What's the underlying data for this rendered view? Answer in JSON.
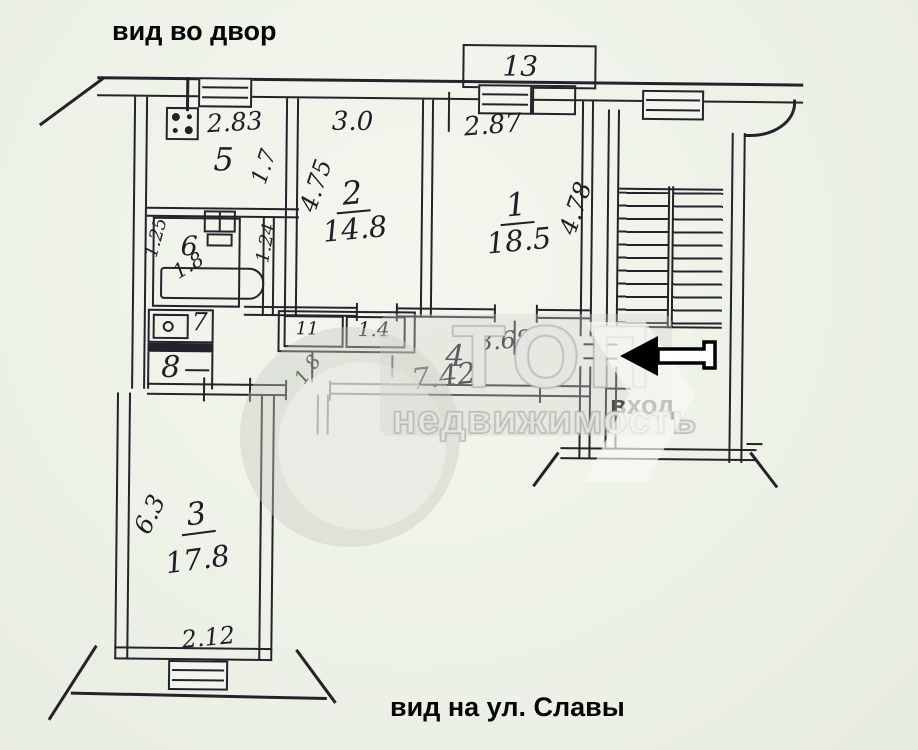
{
  "annotations": {
    "view_top": "вид во двор",
    "entrance": "вход",
    "view_bottom": "вид на ул. Славы"
  },
  "watermark": {
    "brand": "ТОП",
    "brand_sub": "недвижимость"
  },
  "rooms": {
    "living1": {
      "number": "1",
      "area": "18.5",
      "width": "2.87",
      "depth": "4.78"
    },
    "living2": {
      "number": "2",
      "area": "14.8",
      "width": "3.0",
      "depth": "4.75"
    },
    "living3": {
      "number": "3",
      "area": "17.8",
      "depth": "6.3",
      "window_width": "2.12"
    },
    "hall4": {
      "number": "4",
      "area": "7.42",
      "width": "3.68"
    },
    "kitchen5": {
      "number": "5",
      "width": "2.83",
      "depth": "1.7"
    },
    "bath6": {
      "number": "6",
      "area": "1.8",
      "dim_left": "1.25",
      "dim_right": "1.24"
    },
    "wc7": {
      "number": "7"
    },
    "storage8": {
      "number": "8"
    },
    "closet_left": {
      "label": "11"
    },
    "closet_right": {
      "label": "1.4",
      "area": "1.8"
    },
    "balcony": {
      "number": "13"
    }
  }
}
